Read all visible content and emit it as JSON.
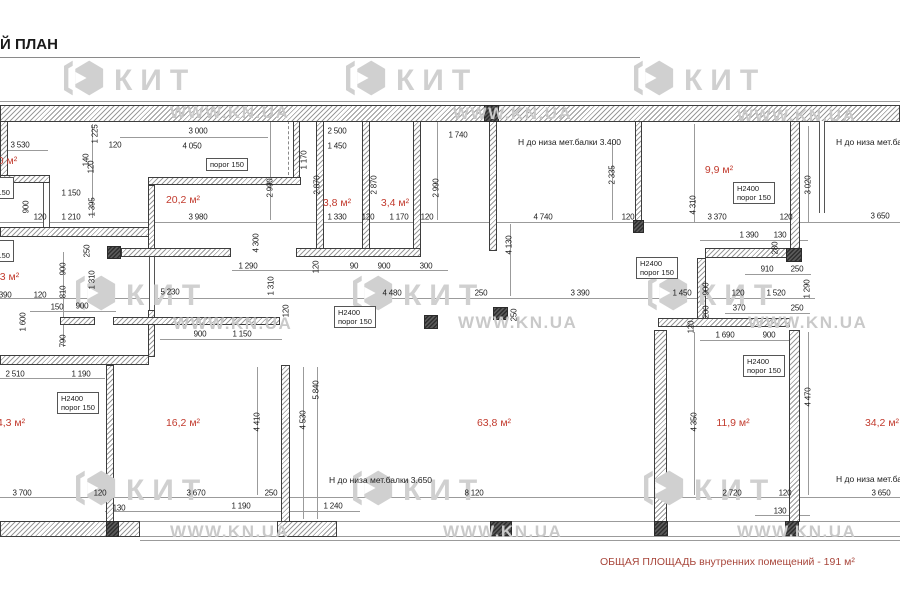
{
  "title": "Й ПЛАН",
  "summary": "ОБЩАЯ ПЛОЩАДЬ внутренних помещений - 191 м²",
  "watermark": {
    "logo_text": "КИТ",
    "url_text": "WWW.KN.UA"
  },
  "colors": {
    "room_label": "#c23b2e",
    "summary_text": "#a8463b",
    "dim_text": "#1c1c1c",
    "watermark": "#d0d0d0",
    "hatch": "#9a9a9a",
    "wall_border": "#3d3d3d"
  },
  "rooms": [
    {
      "t": ",0 м²",
      "x": 6,
      "y": 161
    },
    {
      "t": "20,2 м²",
      "x": 183,
      "y": 200
    },
    {
      "t": "3,8 м²",
      "x": 337,
      "y": 203
    },
    {
      "t": "3,4 м²",
      "x": 395,
      "y": 203
    },
    {
      "t": "9,9 м²",
      "x": 719,
      "y": 170
    },
    {
      "t": ",3 м²",
      "x": 8,
      "y": 277
    },
    {
      "t": "4,3 м²",
      "x": 11,
      "y": 423
    },
    {
      "t": "16,2 м²",
      "x": 183,
      "y": 423
    },
    {
      "t": "63,8 м²",
      "x": 494,
      "y": 423
    },
    {
      "t": "11,9 м²",
      "x": 733,
      "y": 423
    },
    {
      "t": "34,2 м²",
      "x": 882,
      "y": 423
    }
  ],
  "notes": [
    {
      "t": "Н до низа мет.балки 3.400",
      "x": 518,
      "y": 142
    },
    {
      "t": "Н до низа мет.ба",
      "x": 836,
      "y": 142
    },
    {
      "t": "Н до низа мет.балки 3.650",
      "x": 329,
      "y": 480
    },
    {
      "t": "Н до низа мет.ба",
      "x": 836,
      "y": 479
    }
  ],
  "threshold_boxes": [
    {
      "lines": [
        "Н2400",
        "порог 150"
      ],
      "x": -28,
      "y": 177
    },
    {
      "lines": [
        "Н2400",
        "порог 150"
      ],
      "x": -28,
      "y": 240
    },
    {
      "lines": [
        "Н2400",
        "порог 150"
      ],
      "x": 57,
      "y": 392
    },
    {
      "lines": [
        "Н2400",
        "порог 150"
      ],
      "x": 733,
      "y": 182
    },
    {
      "lines": [
        "Н2400",
        "порог 150"
      ],
      "x": 636,
      "y": 257
    },
    {
      "lines": [
        "Н2400",
        "порог 150"
      ],
      "x": 334,
      "y": 306
    },
    {
      "lines": [
        "Н2400",
        "порог 150"
      ],
      "x": 743,
      "y": 355
    },
    {
      "lines": [
        "порог 150"
      ],
      "x": 206,
      "y": 158
    }
  ],
  "dimensions": [
    {
      "t": "3 530",
      "x": 20,
      "y": 145
    },
    {
      "t": "120",
      "x": 115,
      "y": 145
    },
    {
      "t": "3 000",
      "x": 198,
      "y": 131
    },
    {
      "t": "4 050",
      "x": 192,
      "y": 146
    },
    {
      "t": "2 500",
      "x": 337,
      "y": 131
    },
    {
      "t": "1 450",
      "x": 337,
      "y": 146
    },
    {
      "t": "1 740",
      "x": 458,
      "y": 135
    },
    {
      "t": "1 150",
      "x": 71,
      "y": 193
    },
    {
      "t": "1 210",
      "x": 71,
      "y": 217
    },
    {
      "t": "120",
      "x": 40,
      "y": 217
    },
    {
      "t": "3 980",
      "x": 198,
      "y": 217
    },
    {
      "t": "1 330",
      "x": 337,
      "y": 217
    },
    {
      "t": "120",
      "x": 368,
      "y": 217
    },
    {
      "t": "1 170",
      "x": 399,
      "y": 217
    },
    {
      "t": "120",
      "x": 427,
      "y": 217
    },
    {
      "t": "4 740",
      "x": 543,
      "y": 217
    },
    {
      "t": "120",
      "x": 628,
      "y": 217
    },
    {
      "t": "3 370",
      "x": 717,
      "y": 217
    },
    {
      "t": "120",
      "x": 786,
      "y": 217
    },
    {
      "t": "3 650",
      "x": 880,
      "y": 216
    },
    {
      "t": "1 390",
      "x": 749,
      "y": 235
    },
    {
      "t": "130",
      "x": 780,
      "y": 235
    },
    {
      "t": "910",
      "x": 767,
      "y": 269
    },
    {
      "t": "250",
      "x": 797,
      "y": 269
    },
    {
      "t": "1 290",
      "x": 248,
      "y": 266
    },
    {
      "t": "90",
      "x": 354,
      "y": 266
    },
    {
      "t": "900",
      "x": 384,
      "y": 266
    },
    {
      "t": "300",
      "x": 426,
      "y": 266
    },
    {
      "t": "5 230",
      "x": 170,
      "y": 292
    },
    {
      "t": "4 480",
      "x": 392,
      "y": 293
    },
    {
      "t": "250",
      "x": 481,
      "y": 293
    },
    {
      "t": "3 390",
      "x": 580,
      "y": 293
    },
    {
      "t": "1 450",
      "x": 682,
      "y": 293
    },
    {
      "t": "120",
      "x": 738,
      "y": 293
    },
    {
      "t": "1 520",
      "x": 776,
      "y": 293
    },
    {
      "t": "1 390",
      "x": 2,
      "y": 295
    },
    {
      "t": "120",
      "x": 40,
      "y": 295
    },
    {
      "t": "150",
      "x": 57,
      "y": 307
    },
    {
      "t": "900",
      "x": 82,
      "y": 306
    },
    {
      "t": "370",
      "x": 739,
      "y": 308
    },
    {
      "t": "250",
      "x": 797,
      "y": 308
    },
    {
      "t": "900",
      "x": 200,
      "y": 334
    },
    {
      "t": "1 150",
      "x": 242,
      "y": 334
    },
    {
      "t": "1 690",
      "x": 725,
      "y": 335
    },
    {
      "t": "900",
      "x": 769,
      "y": 335
    },
    {
      "t": "2 510",
      "x": 15,
      "y": 374
    },
    {
      "t": "1 190",
      "x": 81,
      "y": 374
    },
    {
      "t": "3 700",
      "x": 22,
      "y": 493
    },
    {
      "t": "120",
      "x": 100,
      "y": 493
    },
    {
      "t": "130",
      "x": 119,
      "y": 508
    },
    {
      "t": "3 670",
      "x": 196,
      "y": 493
    },
    {
      "t": "250",
      "x": 271,
      "y": 493
    },
    {
      "t": "1 190",
      "x": 241,
      "y": 506
    },
    {
      "t": "1 240",
      "x": 333,
      "y": 506
    },
    {
      "t": "8 120",
      "x": 474,
      "y": 493
    },
    {
      "t": "2 720",
      "x": 732,
      "y": 493
    },
    {
      "t": "120",
      "x": 785,
      "y": 493
    },
    {
      "t": "130",
      "x": 780,
      "y": 511
    },
    {
      "t": "3 650",
      "x": 881,
      "y": 493
    },
    {
      "t": "1 225",
      "x": 95,
      "y": 134,
      "v": true
    },
    {
      "t": "120",
      "x": 91,
      "y": 167,
      "v": true
    },
    {
      "t": "140",
      "x": 86,
      "y": 160,
      "v": true
    },
    {
      "t": "900",
      "x": 26,
      "y": 207,
      "v": true
    },
    {
      "t": "1 395",
      "x": 92,
      "y": 207,
      "v": true
    },
    {
      "t": "1 170",
      "x": 304,
      "y": 160,
      "v": true
    },
    {
      "t": "2 990",
      "x": 270,
      "y": 188,
      "v": true
    },
    {
      "t": "2 870",
      "x": 317,
      "y": 185,
      "v": true
    },
    {
      "t": "2 870",
      "x": 374,
      "y": 185,
      "v": true
    },
    {
      "t": "2 990",
      "x": 436,
      "y": 188,
      "v": true
    },
    {
      "t": "2 335",
      "x": 612,
      "y": 175,
      "v": true
    },
    {
      "t": "4 130",
      "x": 509,
      "y": 245,
      "v": true
    },
    {
      "t": "4 310",
      "x": 693,
      "y": 205,
      "v": true
    },
    {
      "t": "3 020",
      "x": 808,
      "y": 185,
      "v": true
    },
    {
      "t": "280",
      "x": 775,
      "y": 248,
      "v": true
    },
    {
      "t": "900",
      "x": 706,
      "y": 289,
      "v": true
    },
    {
      "t": "1 290",
      "x": 807,
      "y": 289,
      "v": true
    },
    {
      "t": "200",
      "x": 706,
      "y": 312,
      "v": true
    },
    {
      "t": "120",
      "x": 691,
      "y": 327,
      "v": true
    },
    {
      "t": "4 300",
      "x": 256,
      "y": 243,
      "v": true
    },
    {
      "t": "120",
      "x": 316,
      "y": 267,
      "v": true
    },
    {
      "t": "1 310",
      "x": 271,
      "y": 286,
      "v": true
    },
    {
      "t": "120",
      "x": 286,
      "y": 311,
      "v": true
    },
    {
      "t": "250",
      "x": 87,
      "y": 251,
      "v": true
    },
    {
      "t": "900",
      "x": 63,
      "y": 269,
      "v": true
    },
    {
      "t": "810",
      "x": 63,
      "y": 292,
      "v": true
    },
    {
      "t": "1 310",
      "x": 92,
      "y": 280,
      "v": true
    },
    {
      "t": "1 600",
      "x": 23,
      "y": 322,
      "v": true
    },
    {
      "t": "790",
      "x": 63,
      "y": 341,
      "v": true
    },
    {
      "t": "250",
      "x": 514,
      "y": 315,
      "v": true
    },
    {
      "t": "5 840",
      "x": 316,
      "y": 390,
      "v": true
    },
    {
      "t": "4 530",
      "x": 303,
      "y": 420,
      "v": true
    },
    {
      "t": "4 410",
      "x": 257,
      "y": 422,
      "v": true
    },
    {
      "t": "4 470",
      "x": 808,
      "y": 397,
      "v": true
    },
    {
      "t": "4 350",
      "x": 694,
      "y": 422,
      "v": true
    }
  ]
}
